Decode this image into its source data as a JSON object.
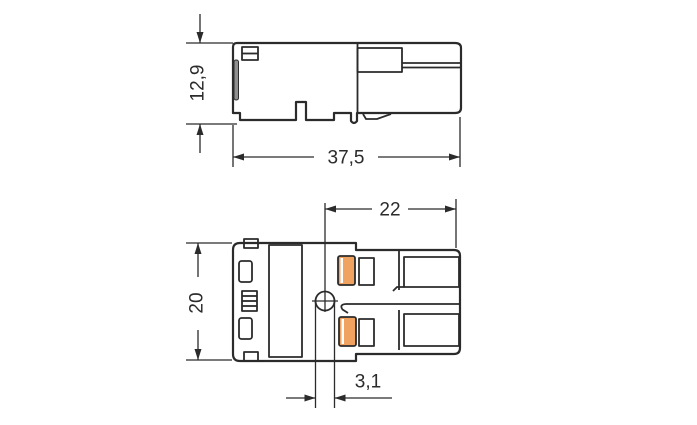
{
  "drawing": {
    "kind": "connector-dimension-drawing",
    "views": {
      "side_view": {
        "height_label": "12,9",
        "length_label": "37,5"
      },
      "front_view": {
        "height_label": "20",
        "depth_label": "22",
        "hole_label": "3,1"
      }
    },
    "colors": {
      "line": "#2b2b2b",
      "accent": "#f0a261",
      "grayfill": "#8f8f8f",
      "background": "#ffffff"
    }
  }
}
